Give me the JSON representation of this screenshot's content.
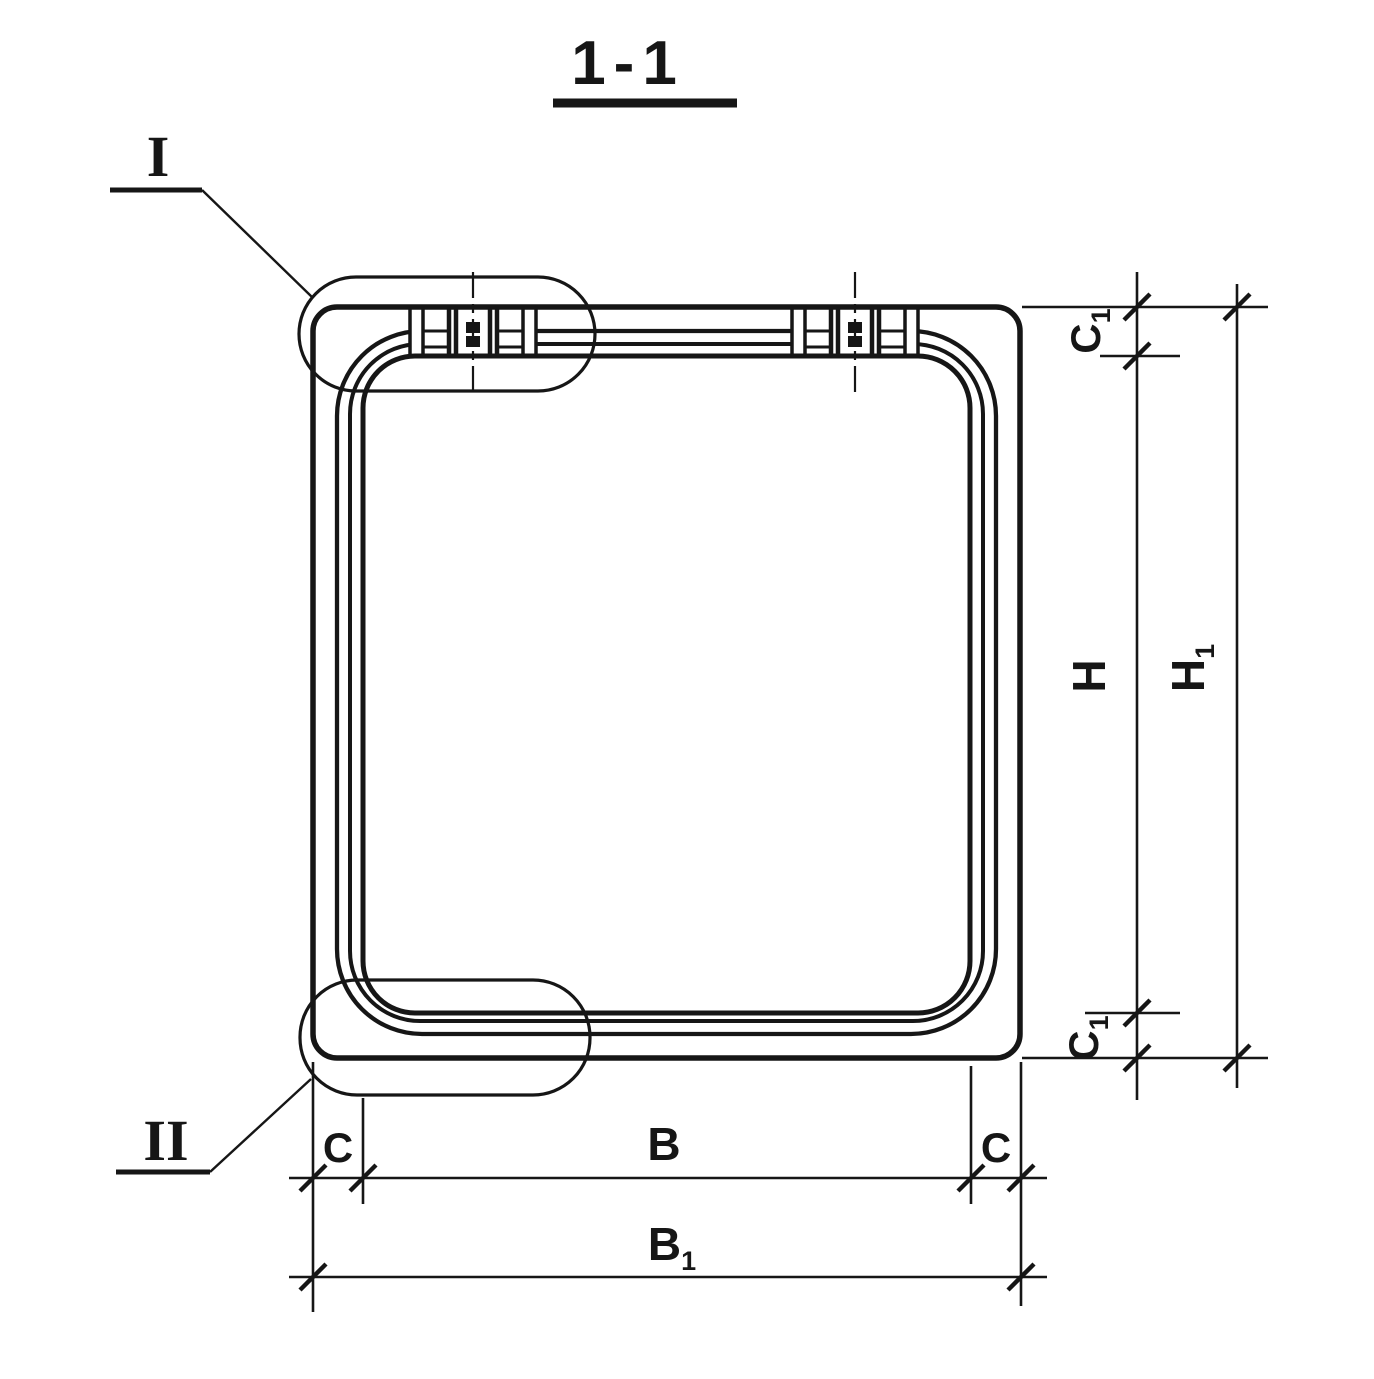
{
  "ink_color": "#161616",
  "title": {
    "label": "1-1"
  },
  "details": {
    "marker_top": "I",
    "marker_bottom": "II"
  },
  "dimensions": {
    "c1_top": {
      "main": "C",
      "sub": "1"
    },
    "h": {
      "main": "H",
      "sub": ""
    },
    "h1": {
      "main": "H",
      "sub": "1"
    },
    "c1_bottom": {
      "main": "C",
      "sub": "1"
    },
    "c_left": {
      "main": "C",
      "sub": ""
    },
    "b": {
      "main": "B",
      "sub": ""
    },
    "c_right": {
      "main": "C",
      "sub": ""
    },
    "b1": {
      "main": "B",
      "sub": "1"
    }
  }
}
